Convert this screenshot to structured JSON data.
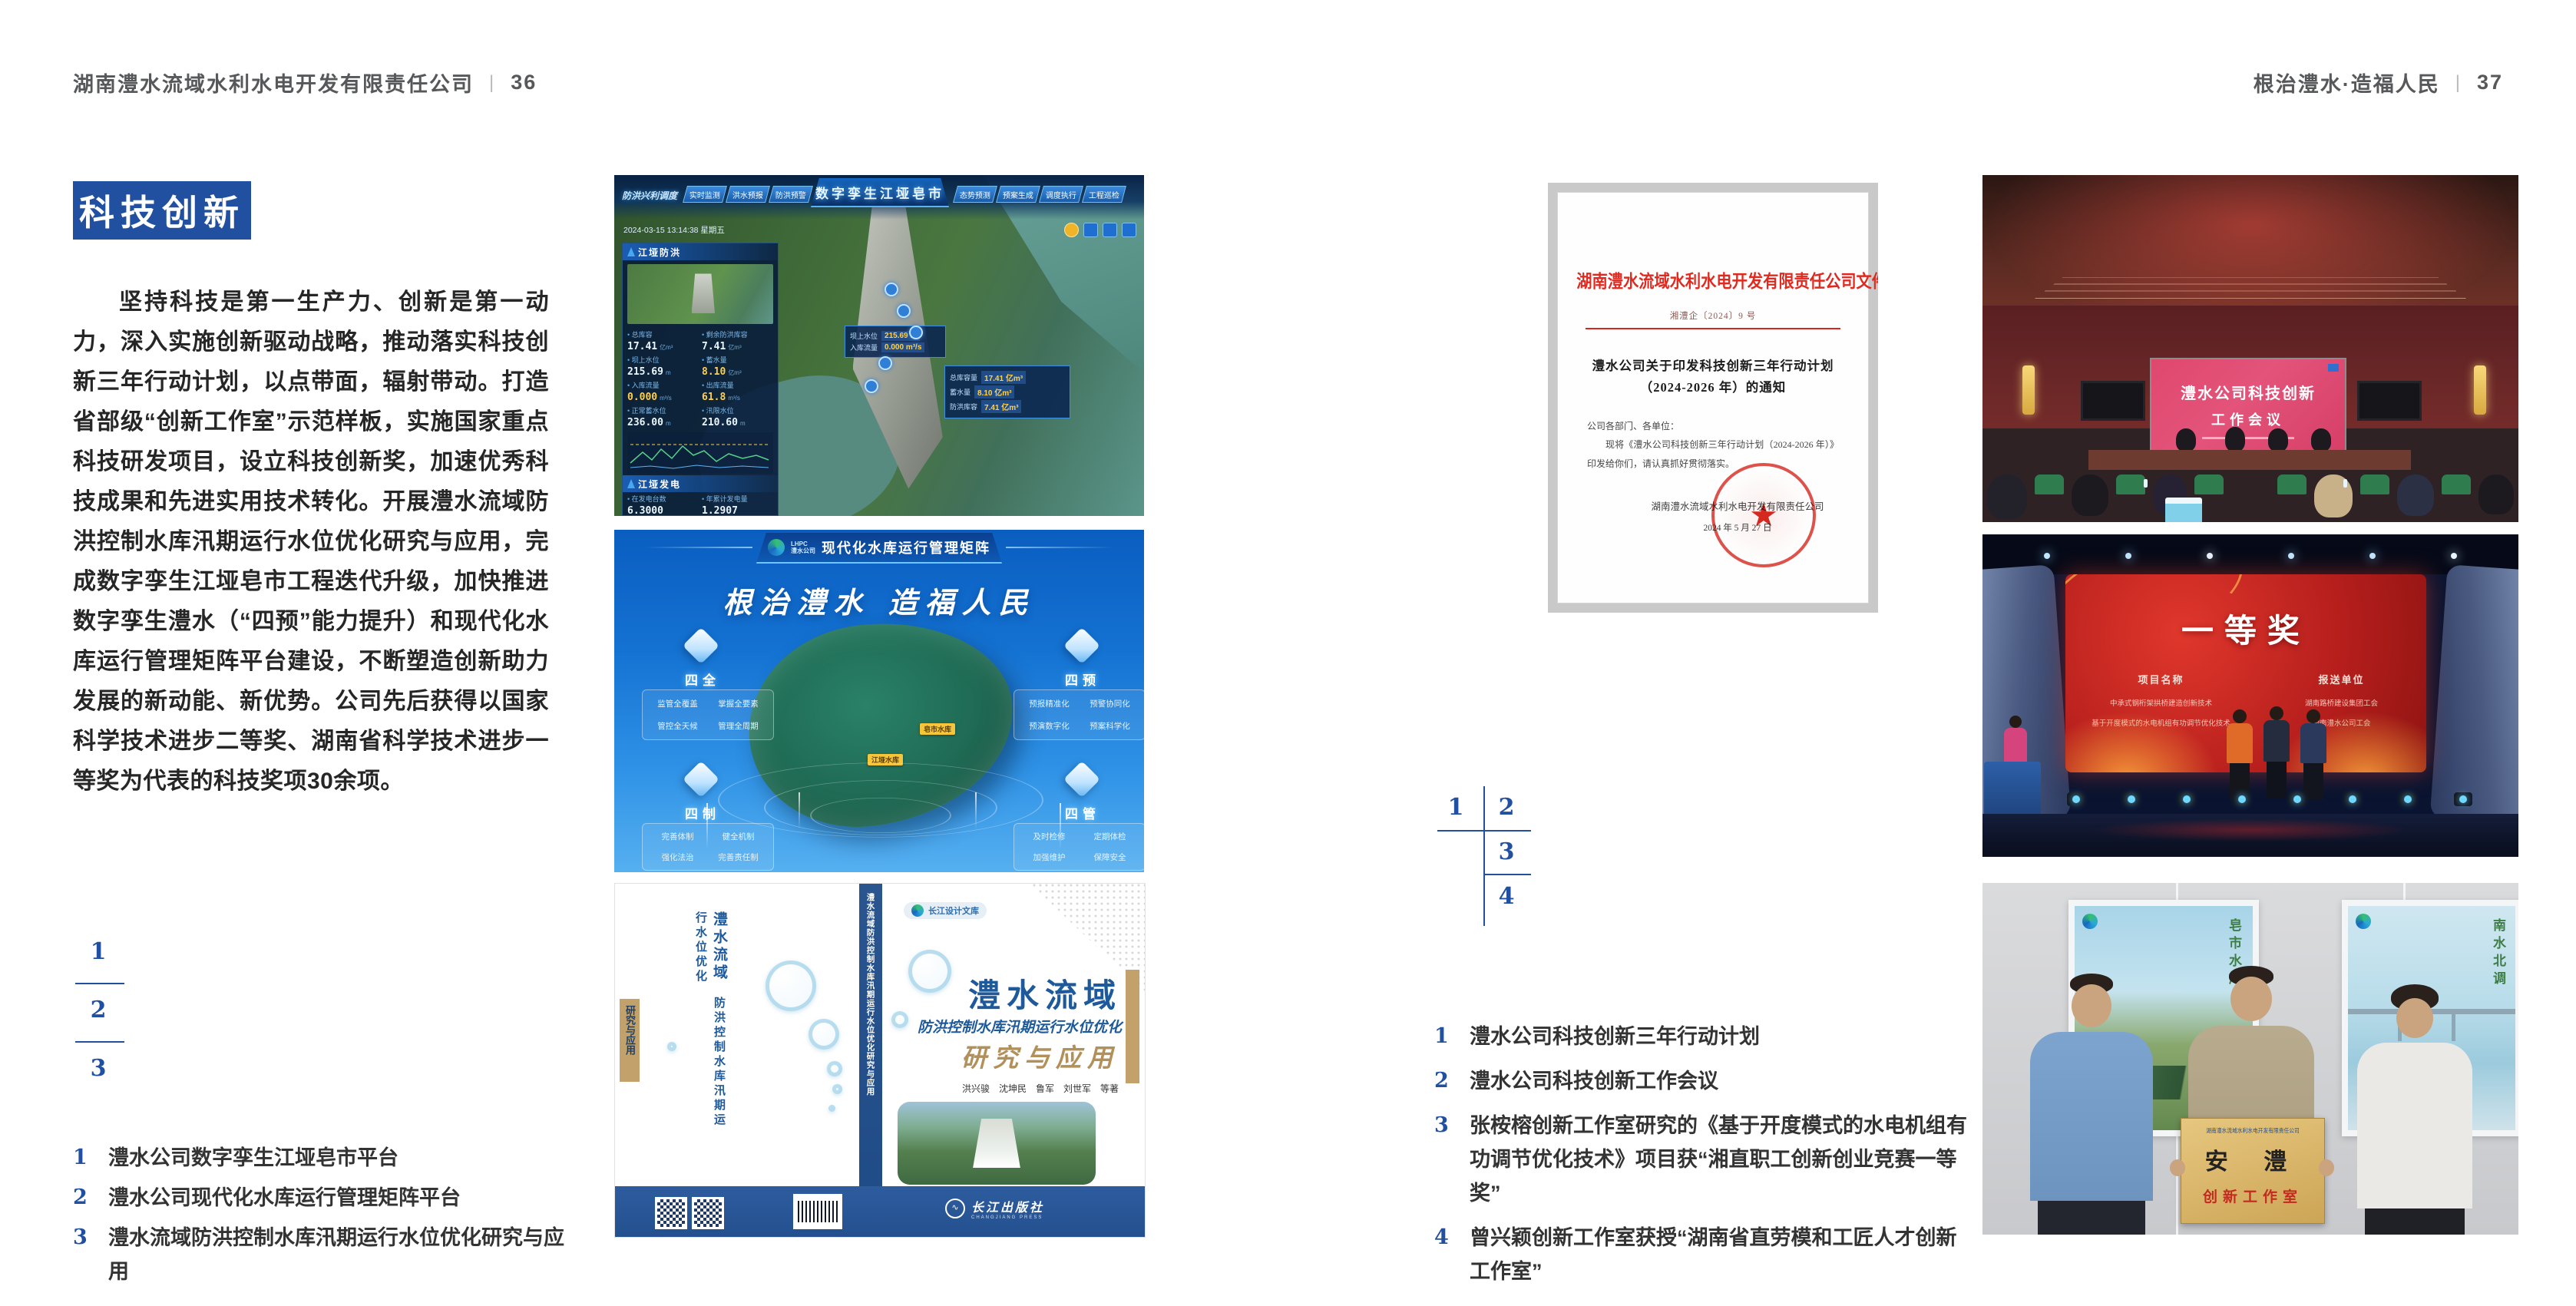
{
  "page_left": {
    "header": {
      "title": "湖南澧水流域水利水电开发有限责任公司",
      "divider": "|",
      "page_no": "36"
    },
    "badge": "科技创新",
    "paragraph": "坚持科技是第一生产力、创新是第一动力，深入实施创新驱动战略，推动落实科技创新三年行动计划，以点带面，辐射带动。打造省部级“创新工作室”示范样板，实施国家重点科技研发项目，设立科技创新奖，加速优秀科技成果和先进实用技术转化。开展澧水流域防洪控制水库汛期运行水位优化研究与应用，完成数字孪生江垭皂市工程迭代升级，加快推进数字孪生澧水（“四预”能力提升）和现代化水库运行管理矩阵平台建设，不断塑造创新助力发展的新动能、新优势。公司先后获得以国家科学技术进步二等奖、湖南省科学技术进步一等奖为代表的科技奖项30余项。",
    "figure_index": {
      "n1": "1",
      "n2": "2",
      "n3": "3"
    },
    "captions": [
      {
        "num": "1",
        "text": "澧水公司数字孪生江垭皂市平台"
      },
      {
        "num": "2",
        "text": "澧水公司现代化水库运行管理矩阵平台"
      },
      {
        "num": "3",
        "text": "澧水流域防洪控制水库汛期运行水位优化研究与应用"
      }
    ]
  },
  "page_right": {
    "header": {
      "title": "根治澧水·造福人民",
      "divider": "|",
      "page_no": "37"
    },
    "figure_index": {
      "n1": "1",
      "n2": "2",
      "n3": "3",
      "n4": "4"
    },
    "captions": [
      {
        "num": "1",
        "text": "澧水公司科技创新三年行动计划"
      },
      {
        "num": "2",
        "text": "澧水公司科技创新工作会议"
      },
      {
        "num": "3",
        "text": "张桉榕创新工作室研究的《基于开度模式的水电机组有功调节优化技术》项目获“湘直职工创新创业竞赛一等奖”"
      },
      {
        "num": "4",
        "text": "曾兴颖创新工作室获授“湖南省直劳模和工匠人才创新工作室”"
      }
    ]
  },
  "digital_twin": {
    "breadcrumb": "防洪兴利调度",
    "title": "数字孪生江垭皂市",
    "tabs_left": [
      "实时监测",
      "洪水预报",
      "防洪预警"
    ],
    "tabs_right": [
      "态势预测",
      "预案生成",
      "调度执行",
      "工程巡检"
    ],
    "timestamp": "2024-03-15 13:14:38 星期五",
    "panel_flood": {
      "title": "江垭防洪",
      "stats": [
        {
          "label": "总库容",
          "value": "17.41",
          "unit": "亿m³"
        },
        {
          "label": "剩余防洪库容",
          "value": "7.41",
          "unit": "亿m³"
        },
        {
          "label": "坝上水位",
          "value": "215.69",
          "unit": "m"
        },
        {
          "label": "蓄水量",
          "value": "8.10",
          "unit": "亿m³"
        },
        {
          "label": "入库流量",
          "value": "0.000",
          "unit": "m³/s"
        },
        {
          "label": "出库流量",
          "value": "61.8",
          "unit": "m³/s"
        },
        {
          "label": "正常蓄水位",
          "value": "236.00",
          "unit": "m"
        },
        {
          "label": "汛限水位",
          "value": "210.60",
          "unit": "m"
        }
      ]
    },
    "panel_power": {
      "title": "江垭发电",
      "stats": [
        {
          "label": "在发电台数",
          "value": "6.3000"
        },
        {
          "label": "年累计发电量",
          "value": "1.2907"
        },
        {
          "label": "月累计发电量",
          "value": "3359.21"
        },
        {
          "label": "当前出力",
          "value": "0.00"
        },
        {
          "label": "发电流量",
          "value": "0.00"
        },
        {
          "label": "弃水流量",
          "value": "102.98"
        }
      ]
    },
    "tooltip": {
      "rows": [
        {
          "label": "坝上水位",
          "value": "215.69 m"
        },
        {
          "label": "入库流量",
          "value": "0.000 m³/s"
        }
      ]
    },
    "side_tip": {
      "rows": [
        {
          "label": "总库容量",
          "value": "17.41 亿m³"
        },
        {
          "label": "蓄水量",
          "value": "8.10 亿m³"
        },
        {
          "label": "防洪库容",
          "value": "7.41 亿m³"
        }
      ]
    }
  },
  "matrix": {
    "logo": "LHPC",
    "logo_sub": "澧水公司",
    "title": "现代化水库运行管理矩阵",
    "slogan": "根治澧水  造福人民",
    "groups": [
      {
        "name": "四全",
        "items": [
          "监管全覆盖",
          "掌握全要素",
          "管控全天候",
          "管理全周期"
        ]
      },
      {
        "name": "四预",
        "items": [
          "预报精准化",
          "预警协同化",
          "预演数字化",
          "预案科学化"
        ]
      },
      {
        "name": "四制",
        "items": [
          "完善体制",
          "健全机制",
          "强化法治",
          "完善责任制"
        ]
      },
      {
        "name": "四管",
        "items": [
          "及时检修",
          "定期体检",
          "加强维护",
          "保障安全"
        ]
      }
    ],
    "map_labels": [
      "皂市水库",
      "江垭水库"
    ]
  },
  "book": {
    "series": "长江设计文库",
    "title": "澧水流域",
    "subtitle": "防洪控制水库汛期运行水位优化",
    "title2": "研究与应用",
    "authors": "洪兴骏　沈坤民　鲁军　刘世军　等著",
    "publisher": "长江出版社",
    "publisher_en": "CHANGJIANG PRESS",
    "spine_title": "澧水流域防洪控制水库汛期运行水位优化研究与应用"
  },
  "document": {
    "org": "湖南澧水流域水利水电开发有限责任公司文件",
    "doc_no": "湘澧企〔2024〕9 号",
    "title_line1": "澧水公司关于印发科技创新三年行动计划",
    "title_line2": "（2024-2026 年）的通知",
    "salutation": "公司各部门、各单位：",
    "body": "现将《澧水公司科技创新三年行动计划（2024-2026 年）》印发给你们，请认真抓好贯彻落实。",
    "signer": "湖南澧水流域水利水电开发有限责任公司",
    "date": "2024 年 5 月 27 日",
    "star": "★"
  },
  "meeting": {
    "screen_line1": "澧水公司科技创新",
    "screen_line2": "工作会议"
  },
  "award": {
    "title": "一等奖",
    "col_project": "项目名称",
    "col_unit": "报送单位",
    "rows": [
      {
        "project": "中承式钢桁架拱桥建造创新技术",
        "unit": "湖南路桥建设集团工会"
      },
      {
        "project": "基于开度模式的水电机组有功调节优化技术",
        "unit": "湖南澧水公司工会"
      }
    ]
  },
  "plaque": {
    "header": "湖南澧水流域水利水电开发有限责任公司",
    "name": "安 澧",
    "subtitle": "创新工作室",
    "poster_left_caption": "皂市水库",
    "poster_right_caption": "南水北调"
  }
}
